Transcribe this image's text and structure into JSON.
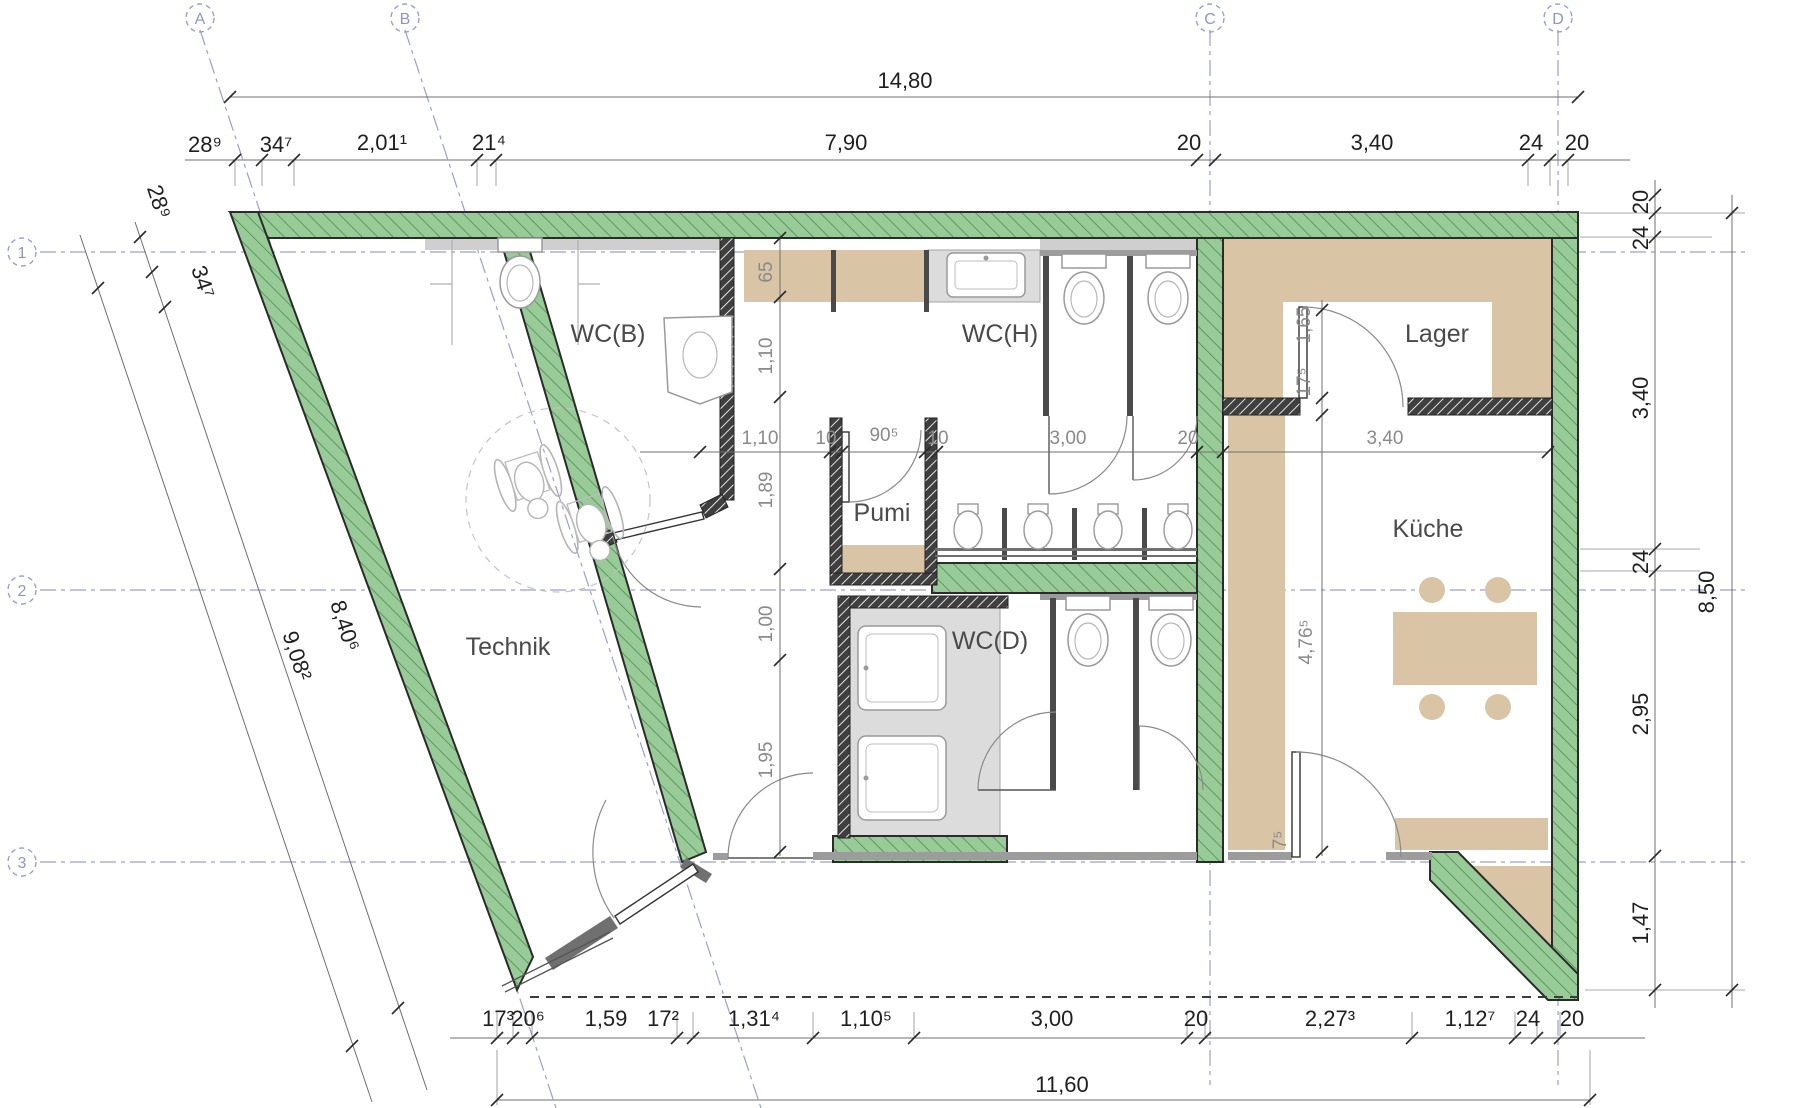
{
  "axes": {
    "cols": [
      {
        "label": "A"
      },
      {
        "label": "B"
      },
      {
        "label": "C"
      },
      {
        "label": "D"
      }
    ],
    "rows": [
      {
        "label": "1"
      },
      {
        "label": "2"
      },
      {
        "label": "3"
      }
    ]
  },
  "rooms": {
    "wcb": "WC(B)",
    "wch": "WC(H)",
    "lager": "Lager",
    "pumi": "Pumi",
    "technik": "Technik",
    "wcd": "WC(D)",
    "kueche": "Küche"
  },
  "dims": {
    "top_total": "14,80",
    "top_chain": [
      "28⁹",
      "34⁷",
      "2,01¹",
      "21⁴",
      "7,90",
      "20",
      "3,40",
      "24",
      "20"
    ],
    "left_chain": [
      "28⁹",
      "34⁷"
    ],
    "left_totals": [
      "9,08²",
      "8,40⁶"
    ],
    "right_chain": [
      "20",
      "24",
      "3,40",
      "24",
      "2,95",
      "1,47"
    ],
    "right_total": "8,50",
    "bottom_chain": [
      "17³",
      "20⁶",
      "1,59",
      "17²",
      "1,31⁴",
      "1,10⁵",
      "3,00",
      "20",
      "2,27³",
      "1,12⁷",
      "24",
      "20"
    ],
    "bottom_total": "11,60",
    "mid_h": [
      "1,10",
      "10",
      "90⁵",
      "10",
      "3,00",
      "20",
      "3,40"
    ],
    "mid_v": [
      "65",
      "1,10",
      "1,89",
      "1,00",
      "1,95"
    ],
    "kitchen_height": "4,76⁵",
    "kitchen_door": "7⁵",
    "lager_door_wall": "17⁵",
    "lager_door_width": "1,65"
  },
  "colors": {
    "wall_green": "#98cb98",
    "wall_hatch": "#4e8c52",
    "floor_tan": "#d9c4a6",
    "counter_grey": "#dcdcdc",
    "axis_purple": "#9aa0cf",
    "dim_dark": "#1f1f1f",
    "dim_grey": "#8a8a8a"
  }
}
